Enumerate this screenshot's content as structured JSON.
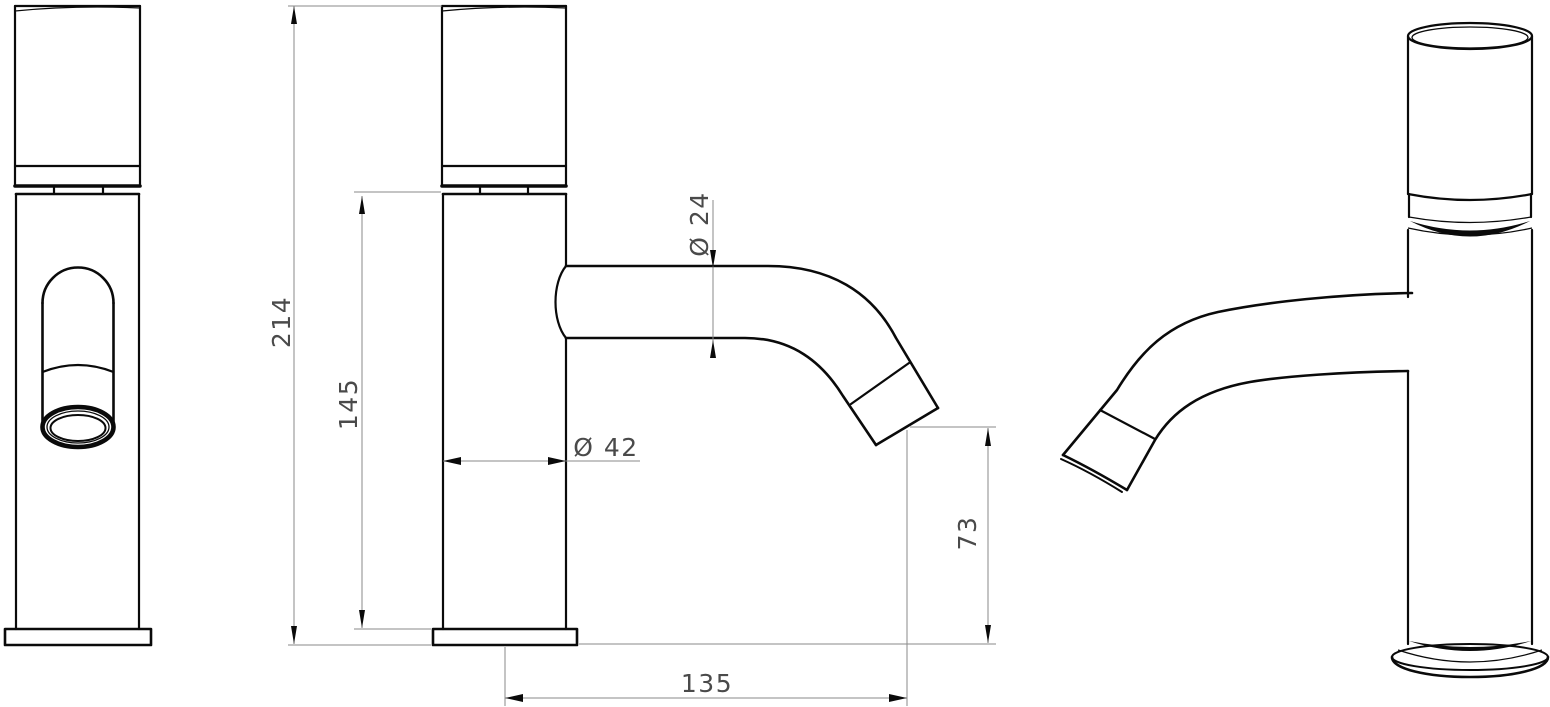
{
  "drawing": {
    "title": "Single-lever basin faucet dimensional drawing, three views",
    "dimensions": {
      "total_height": "214",
      "body_height": "145",
      "body_diameter": "Ø 42",
      "spout_diameter": "Ø 24",
      "outlet_height": "73",
      "spout_reach": "135"
    },
    "colors": {
      "background": "#ffffff",
      "outline": "#0a0a0a",
      "dimension_line": "#8a8a8a",
      "dimension_text": "#4a4a4a"
    }
  }
}
